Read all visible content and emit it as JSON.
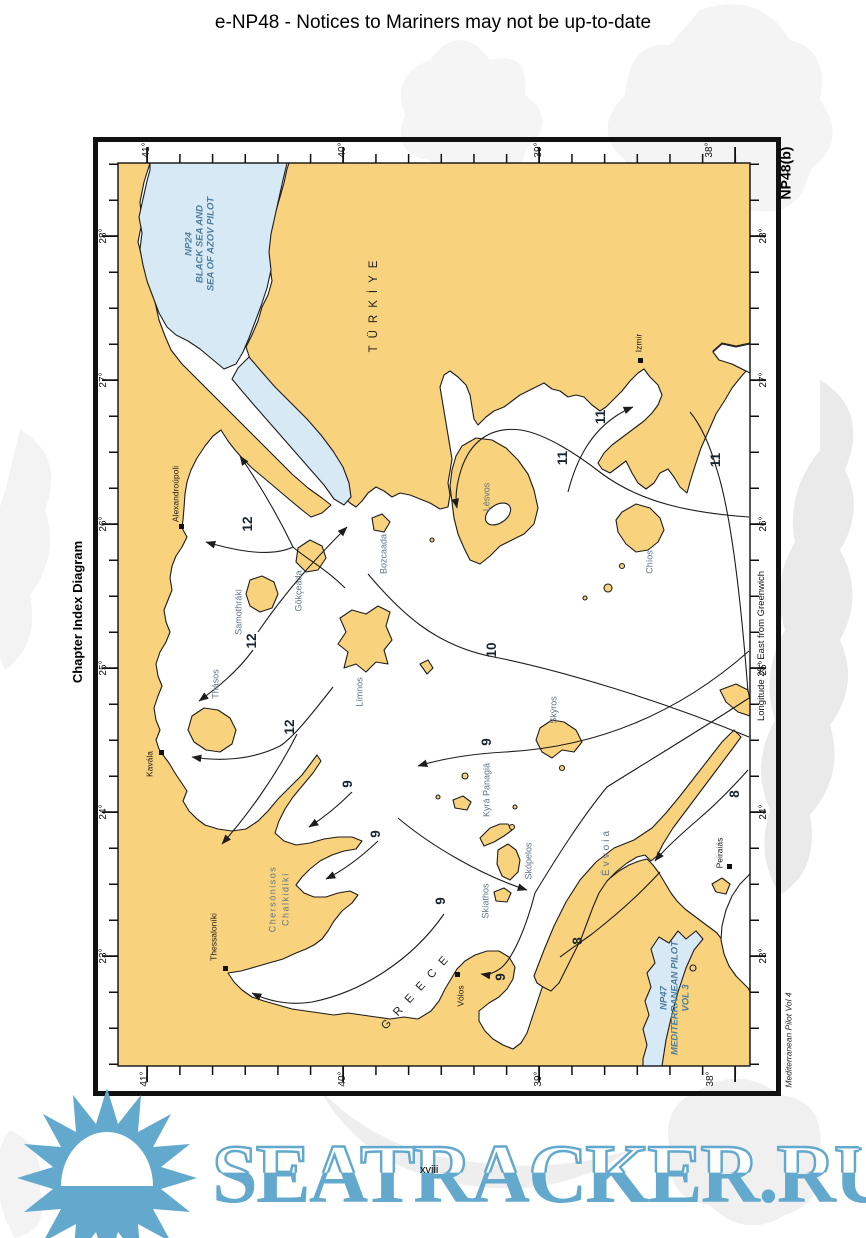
{
  "header": {
    "title": "e-NP48 - Notices to Mariners may not be up-to-date"
  },
  "chart": {
    "corner_label": "NP48(b)",
    "side_title": "Chapter Index Diagram",
    "credit": "Mediterranean Pilot Vol 4",
    "longitude_note": "Longitude 25° East from Greenwich",
    "axes": {
      "top": [
        "41°",
        "40°",
        "39°",
        "38°"
      ],
      "bottom": [
        "41°",
        "40°",
        "39°",
        "38°"
      ],
      "left": [
        "28°",
        "27°",
        "26°",
        "25°",
        "24°",
        "23°"
      ],
      "right": [
        "28°",
        "27°",
        "26°",
        "25°",
        "24°",
        "23°"
      ]
    },
    "countries": {
      "turkiye": "TÜRKİYE",
      "greece": "GREECE"
    },
    "sea_regions": {
      "np24_lines": [
        "NP24",
        "BLACK SEA AND",
        "SEA OF AZOV PILOT"
      ],
      "np47_lines": [
        "NP47",
        "MEDITERRANEAN PILOT",
        "VOL 3"
      ]
    },
    "cities": {
      "alexandroupoli": "Alexandroúpoli",
      "kavala": "Kavála",
      "thessaloniki": "Thessaloníki",
      "volos": "Vólos",
      "izmir": "Izmir",
      "peiraias": "Peiraiás"
    },
    "islands": {
      "lesvos": "Lésvos",
      "chios": "Chíos",
      "limnos": "Límnos",
      "thasos": "Thásos",
      "samothraki": "Samothráki",
      "gokceada": "Gökçeada",
      "bozcaada": "Bozcaada",
      "skyros": "Skýros",
      "skiathos": "Skíathos",
      "skopelos": "Skópelos",
      "kyra_panagia": "Kyrá Panagiá",
      "evvoia": "Évvoia",
      "chalkidiki_line1": "Chersónisos",
      "chalkidiki_line2": "Chalkidikí"
    },
    "chapter_labels": {
      "ch8a": "8",
      "ch8b": "8",
      "ch9a": "9",
      "ch9b": "9",
      "ch9c": "9",
      "ch9d": "9",
      "ch9e": "9",
      "ch10": "10",
      "ch11a": "11",
      "ch11b": "11",
      "ch11c": "11",
      "ch12a": "12",
      "ch12b": "12",
      "ch12c": "12"
    }
  },
  "footer": {
    "page_number": "xviii",
    "watermark_text": "SEATRACKER.RU"
  },
  "colors": {
    "land": "#F8D27C",
    "shallow_water": "#D7E9F5",
    "watermark_blue": "#63A9CD"
  }
}
